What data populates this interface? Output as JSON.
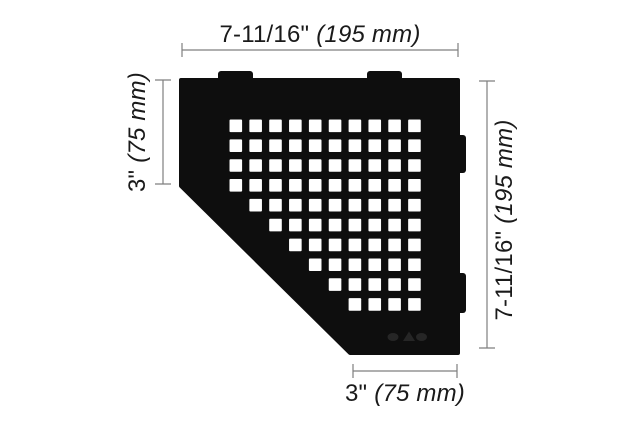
{
  "drawing": {
    "type": "technical-dimension-drawing",
    "object": "pentagonal corner shelf with square perforation pattern"
  },
  "colors": {
    "background": "#ffffff",
    "shelf": "#0e0e0e",
    "hole": "#ffffff",
    "dimension_line": "#7f7f7f",
    "text": "#1a1a1a",
    "logo_mark": "#262626"
  },
  "dimensions": {
    "top": {
      "inches": "7-11/16\"",
      "mm": "(195 mm)"
    },
    "left": {
      "inches": "3\"",
      "mm": "(75 mm)"
    },
    "right": {
      "inches": "7-11/16\"",
      "mm": "(195 mm)"
    },
    "bottom": {
      "inches": "3\"",
      "mm": "(75 mm)"
    }
  },
  "shelf": {
    "outline_points": "181,80 458,80 458,353 350,353 181,186",
    "tabs_top": [
      {
        "x": 218,
        "y": 71,
        "w": 35,
        "h": 12
      },
      {
        "x": 367,
        "y": 71,
        "w": 35,
        "h": 12
      }
    ],
    "tabs_right": [
      {
        "x": 453,
        "y": 135,
        "w": 13,
        "h": 38
      },
      {
        "x": 453,
        "y": 273,
        "w": 13,
        "h": 40
      }
    ],
    "hole_pattern": {
      "x0": 229.5,
      "y0": 119.5,
      "pitch": 19.85,
      "size": 12.6,
      "rows": [
        {
          "from": 0,
          "to": 9
        },
        {
          "from": 0,
          "to": 9
        },
        {
          "from": 0,
          "to": 9
        },
        {
          "from": 0,
          "to": 9
        },
        {
          "from": 1,
          "to": 9
        },
        {
          "from": 2,
          "to": 9
        },
        {
          "from": 3,
          "to": 9
        },
        {
          "from": 4,
          "to": 9
        },
        {
          "from": 5,
          "to": 9
        },
        {
          "from": 6,
          "to": 9
        }
      ]
    }
  }
}
